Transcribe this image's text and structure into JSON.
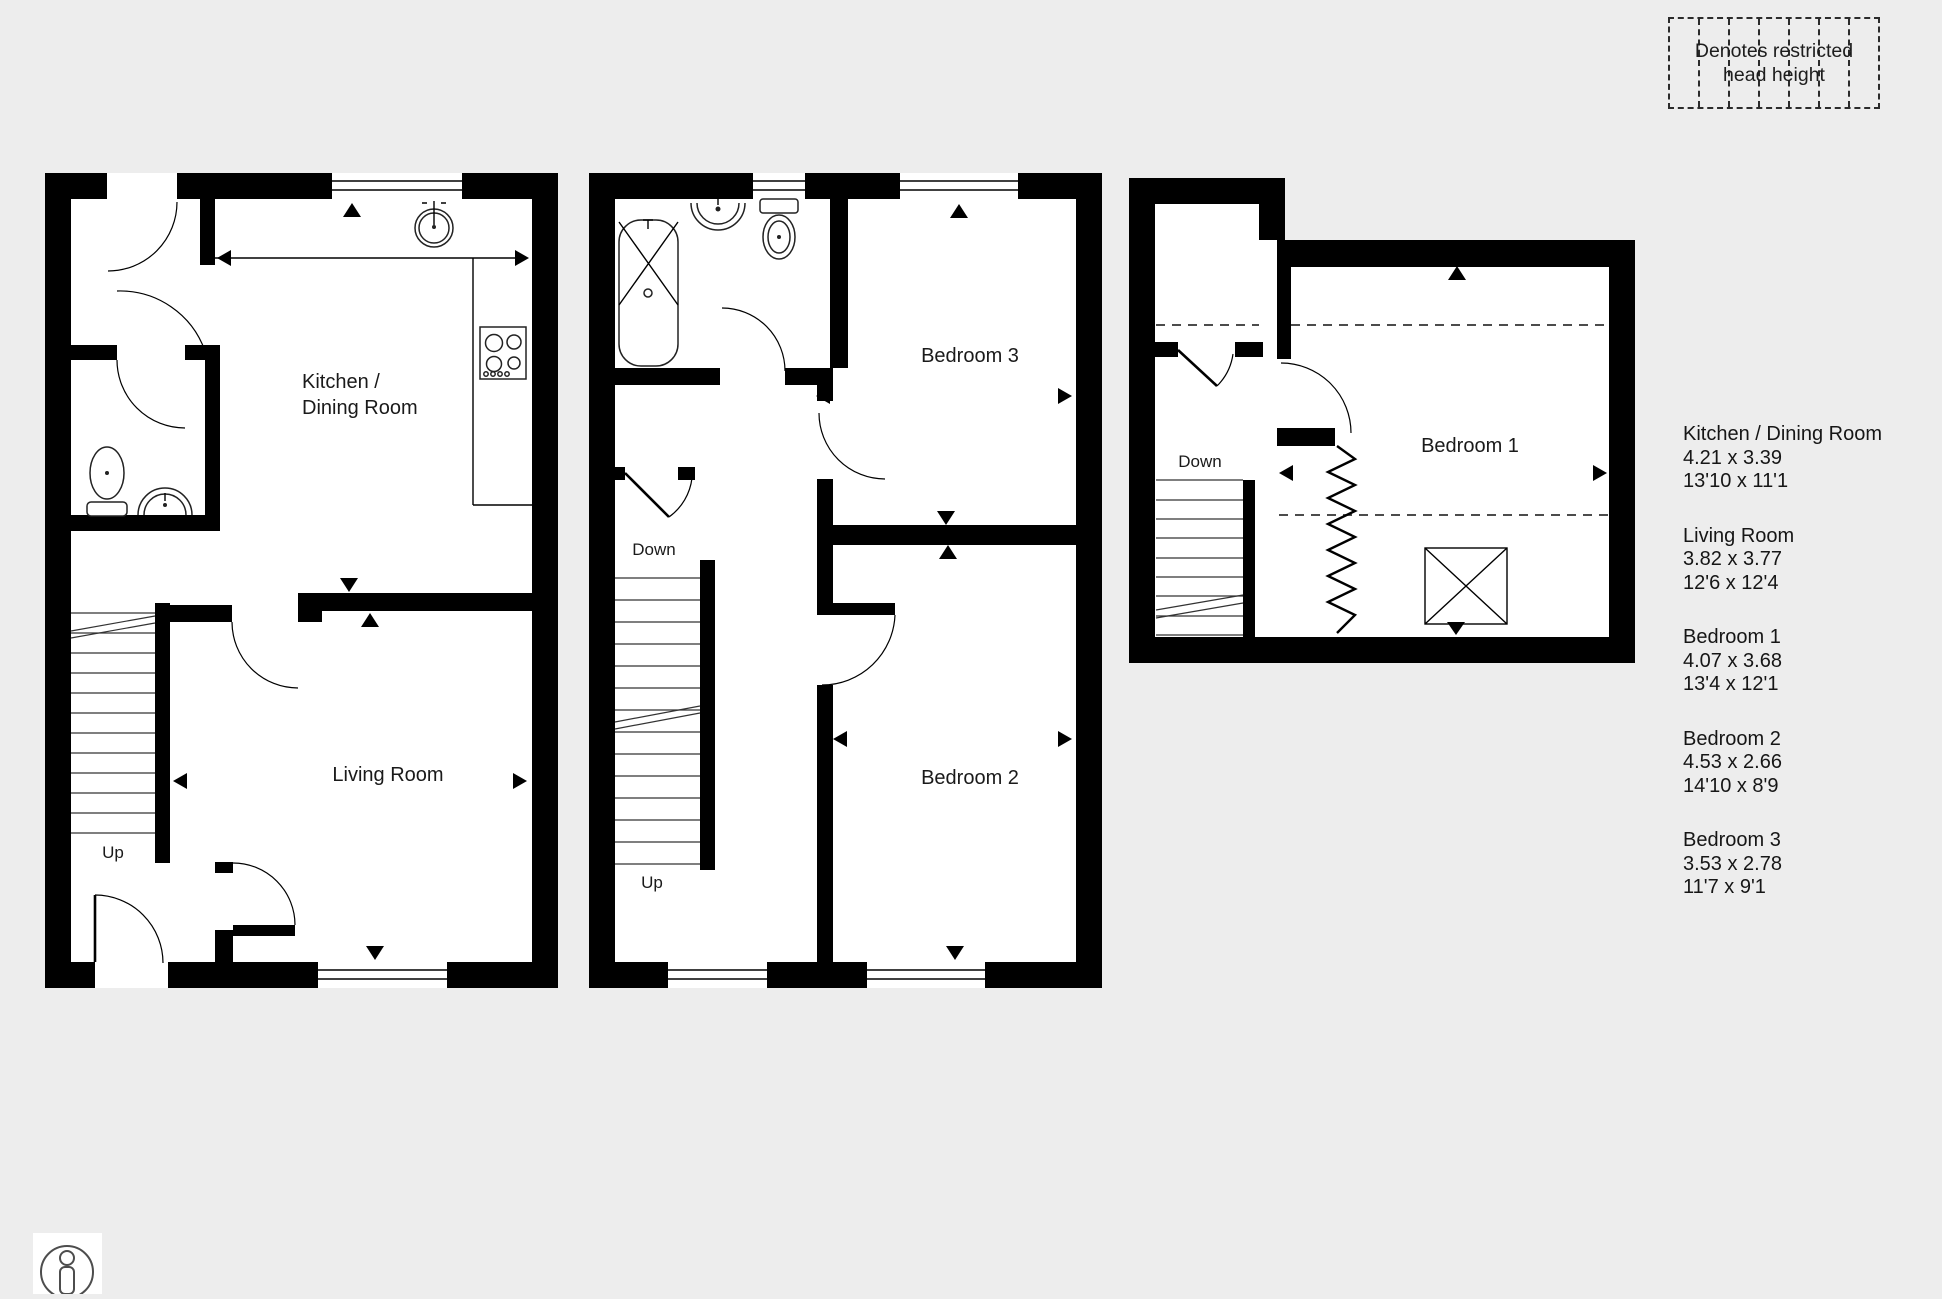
{
  "colors": {
    "background": "#ededed",
    "wall": "#000000",
    "text": "#1a1a1a"
  },
  "legend": {
    "line1": "Denotes restricted",
    "line2": "head height"
  },
  "plans": {
    "ground": {
      "kitchen_line1": "Kitchen /",
      "kitchen_line2": "Dining Room",
      "living": "Living Room",
      "up": "Up"
    },
    "first": {
      "bedroom3": "Bedroom 3",
      "bedroom2": "Bedroom 2",
      "down": "Down",
      "up": "Up"
    },
    "second": {
      "bedroom1": "Bedroom 1",
      "down": "Down"
    }
  },
  "rooms": [
    {
      "name": "Kitchen / Dining Room",
      "metric": "4.21 x 3.39",
      "imperial": "13'10 x 11'1"
    },
    {
      "name": "Living Room",
      "metric": "3.82 x 3.77",
      "imperial": "12'6 x 12'4"
    },
    {
      "name": "Bedroom 1",
      "metric": "4.07 x 3.68",
      "imperial": "13'4 x 12'1"
    },
    {
      "name": "Bedroom 2",
      "metric": "4.53 x 2.66",
      "imperial": "14'10 x 8'9"
    },
    {
      "name": "Bedroom 3",
      "metric": "3.53 x 2.78",
      "imperial": "11'7 x 9'1"
    }
  ]
}
